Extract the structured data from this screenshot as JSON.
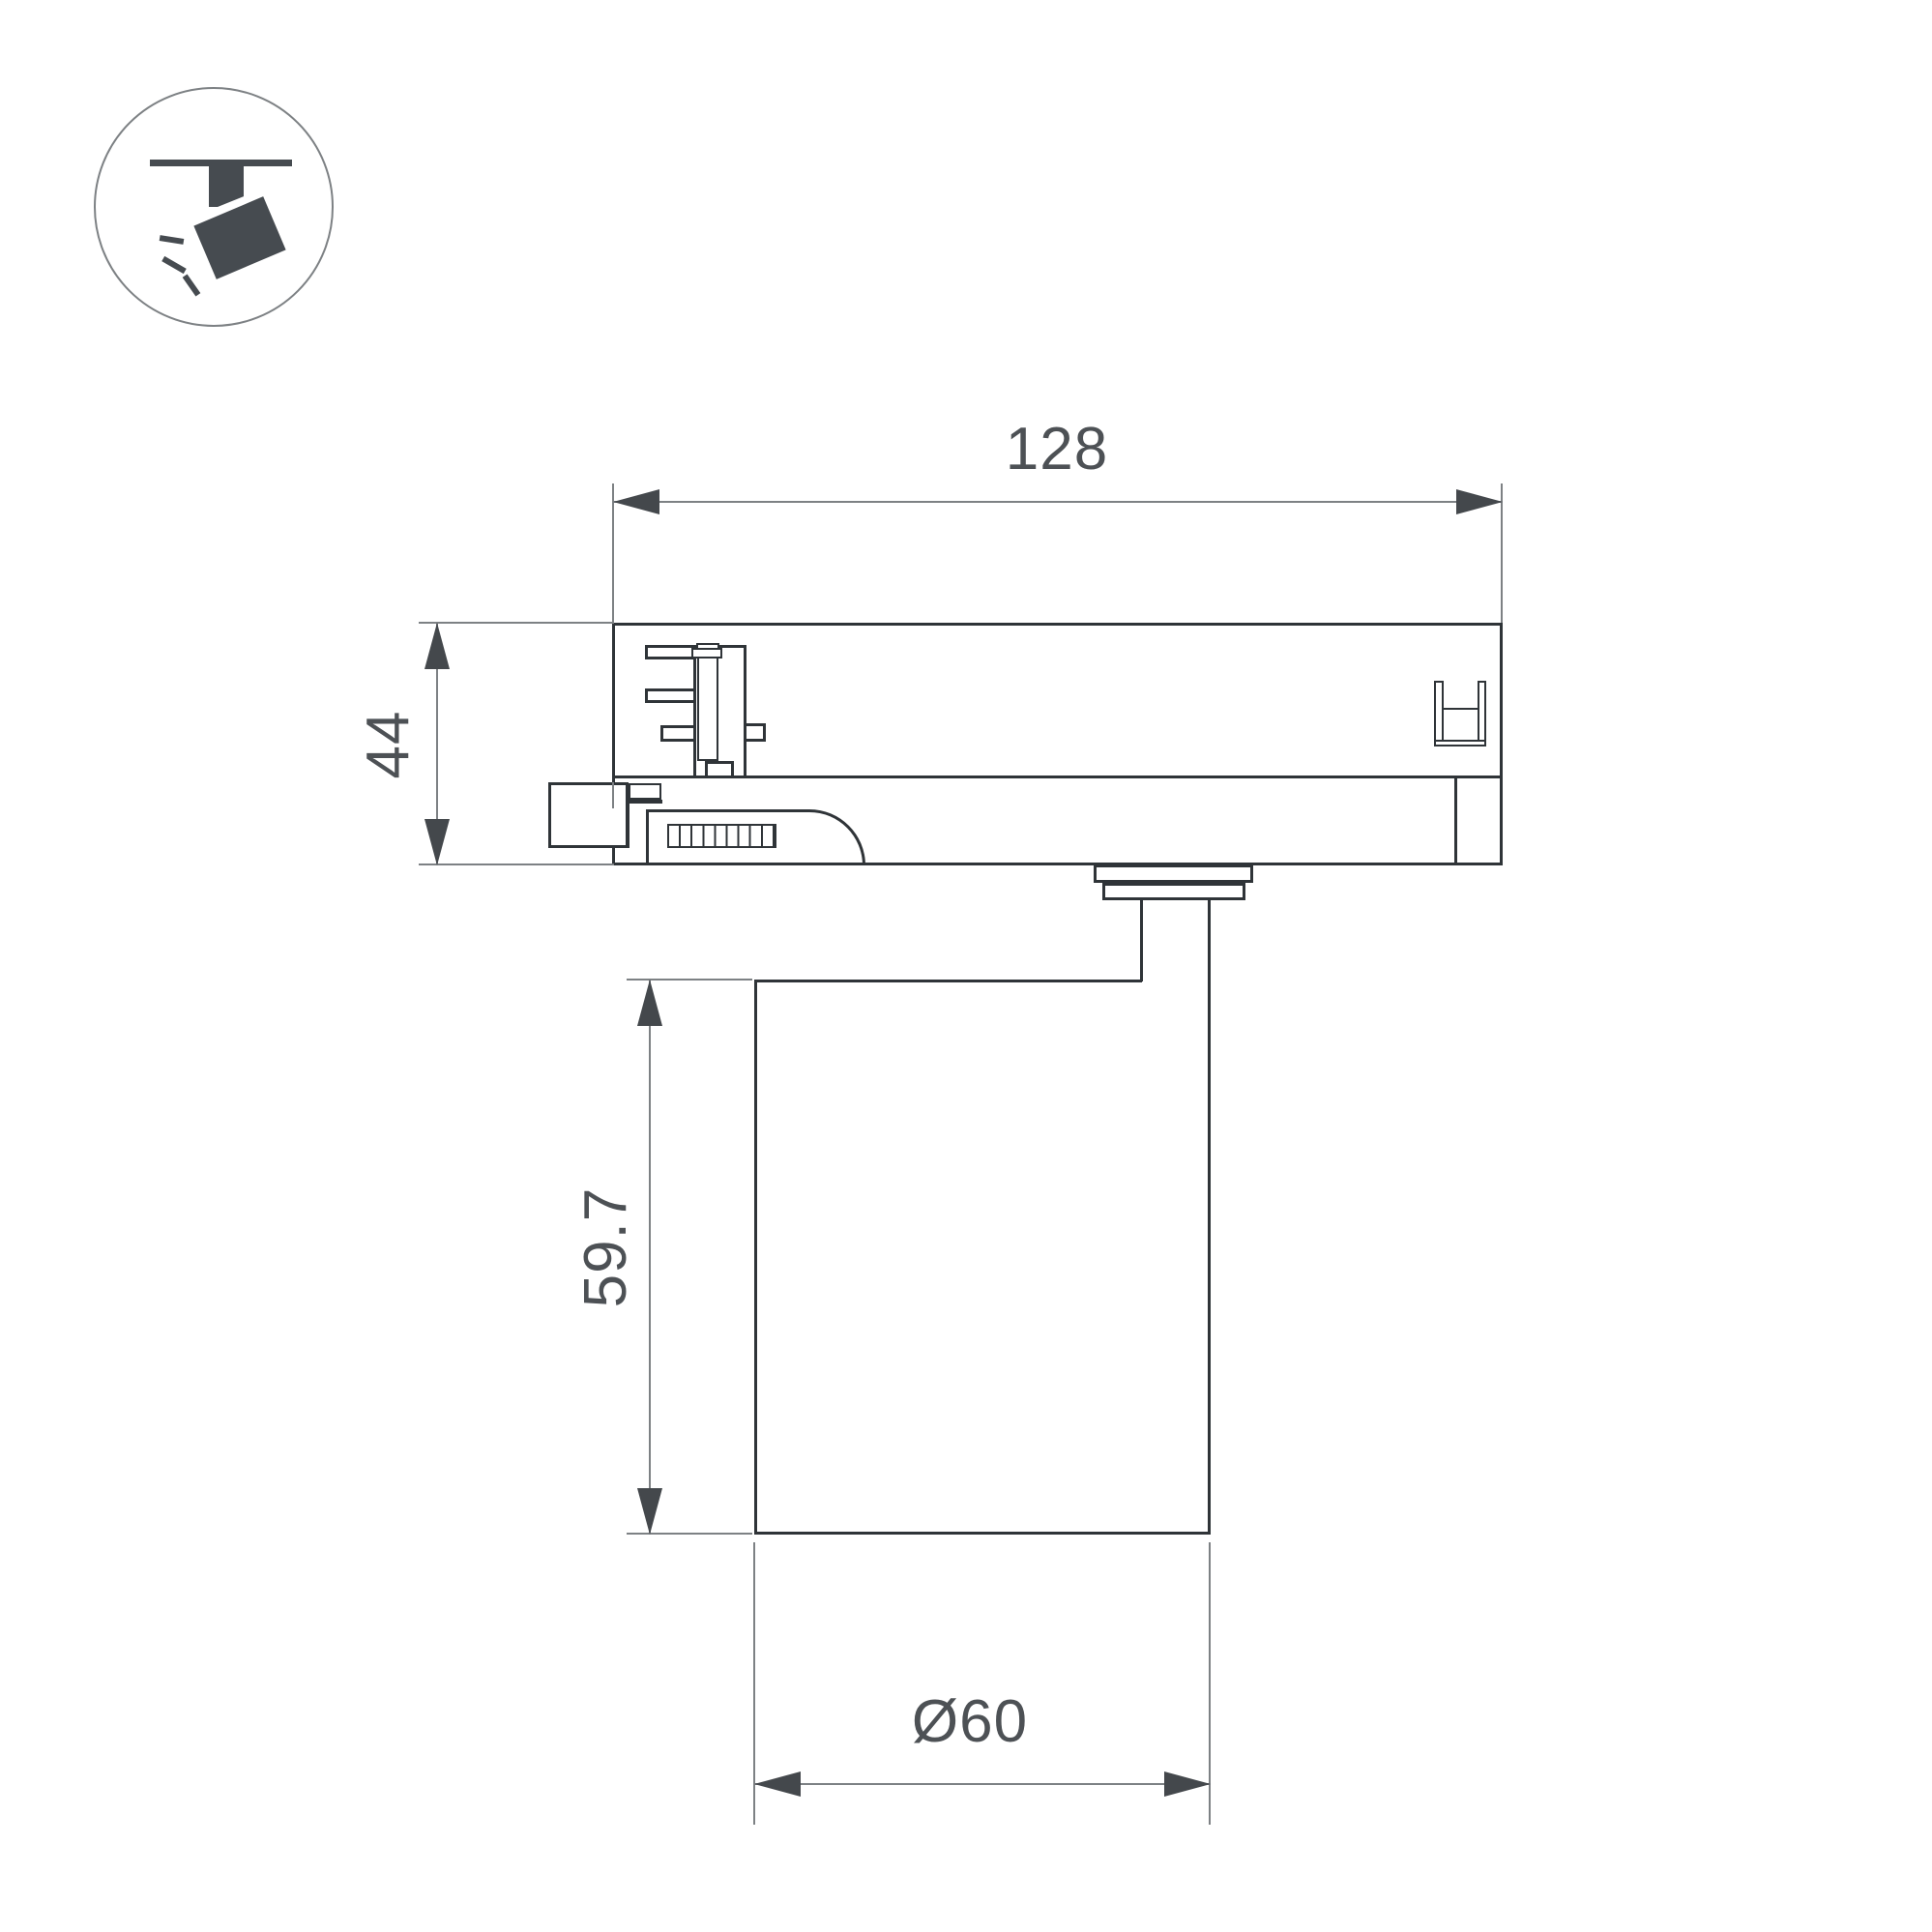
{
  "icon": {
    "name": "track-spotlight-icon"
  },
  "dimensions": {
    "track_adapter_width": {
      "label": "128"
    },
    "track_adapter_height": {
      "label": "44"
    },
    "lamp_body_height": {
      "label": "59.7"
    },
    "lamp_body_diameter": {
      "label": "Ø60"
    }
  },
  "colors": {
    "background": "#ffffff",
    "object_line": "#2f3438",
    "dimension_line": "#7d8184",
    "arrow": "#44484c",
    "text": "#4d5155",
    "icon": "#464b50"
  }
}
